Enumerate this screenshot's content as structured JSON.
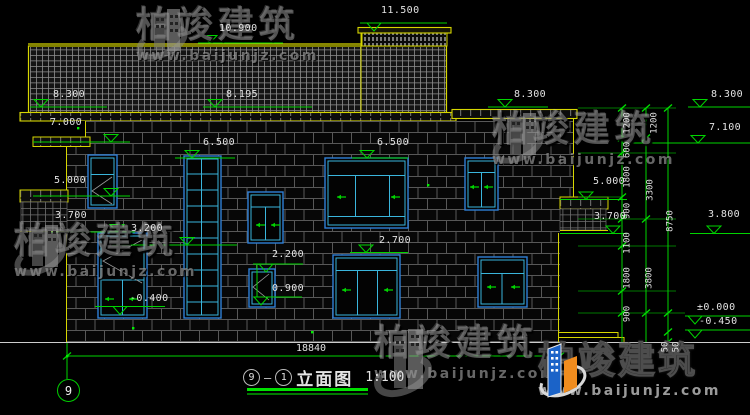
{
  "drawing": {
    "type": "building-elevation-cad",
    "background": "#000000"
  },
  "colors": {
    "dim_green": "#00d400",
    "outline_yellow": "#d6d600",
    "window_blue": "#2f7fd6",
    "window_cyan": "#3ab5dc",
    "text_white": "#e2e2e2",
    "logo_blue": "#1b63c8",
    "logo_orange": "#f08c1e"
  },
  "elevation_labels": [
    {
      "text": "11.500",
      "x": 381,
      "y": 6
    },
    {
      "text": "10.900",
      "x": 219,
      "y": 24
    },
    {
      "text": "8.300",
      "x": 53,
      "y": 90
    },
    {
      "text": "8.195",
      "x": 226,
      "y": 90
    },
    {
      "text": "8.300",
      "x": 514,
      "y": 90
    },
    {
      "text": "8.300",
      "x": 711,
      "y": 90
    },
    {
      "text": "7.000",
      "x": 50,
      "y": 118
    },
    {
      "text": "7.100",
      "x": 709,
      "y": 123
    },
    {
      "text": "6.500",
      "x": 203,
      "y": 138
    },
    {
      "text": "6.500",
      "x": 377,
      "y": 138
    },
    {
      "text": "5.000",
      "x": 54,
      "y": 176
    },
    {
      "text": "5.000",
      "x": 593,
      "y": 177
    },
    {
      "text": "3.700",
      "x": 55,
      "y": 211
    },
    {
      "text": "3.700",
      "x": 594,
      "y": 212
    },
    {
      "text": "3.800",
      "x": 708,
      "y": 210
    },
    {
      "text": "3.200",
      "x": 131,
      "y": 224
    },
    {
      "text": "2.700",
      "x": 379,
      "y": 236
    },
    {
      "text": "2.200",
      "x": 272,
      "y": 250
    },
    {
      "text": "0.900",
      "x": 272,
      "y": 284
    },
    {
      "text": "-0.400",
      "x": 130,
      "y": 294
    },
    {
      "text": "±0.000",
      "x": 697,
      "y": 303
    },
    {
      "text": "-0.450",
      "x": 699,
      "y": 317
    }
  ],
  "vertical_dims": [
    {
      "text": "1200",
      "x": 628,
      "y": 123
    },
    {
      "text": "600",
      "x": 628,
      "y": 150
    },
    {
      "text": "1800",
      "x": 628,
      "y": 177
    },
    {
      "text": "900",
      "x": 628,
      "y": 211
    },
    {
      "text": "1100",
      "x": 628,
      "y": 243
    },
    {
      "text": "1800",
      "x": 628,
      "y": 278
    },
    {
      "text": "900",
      "x": 628,
      "y": 314
    },
    {
      "text": "1200",
      "x": 655,
      "y": 123
    },
    {
      "text": "3300",
      "x": 651,
      "y": 190
    },
    {
      "text": "3800",
      "x": 650,
      "y": 278
    },
    {
      "text": "8750",
      "x": 671,
      "y": 221
    },
    {
      "text": "50",
      "x": 666,
      "y": 347
    },
    {
      "text": "50",
      "x": 677,
      "y": 347
    }
  ],
  "bottom_dim": {
    "text": "18840"
  },
  "title_block": {
    "axis_left": "9",
    "separator": "—",
    "axis_right": "1",
    "name": "立面图",
    "scale": "1:100",
    "grid_axis_bubble": "9"
  },
  "watermark": {
    "brand": "柏竣建筑",
    "url": "www.baijunjz.com"
  }
}
